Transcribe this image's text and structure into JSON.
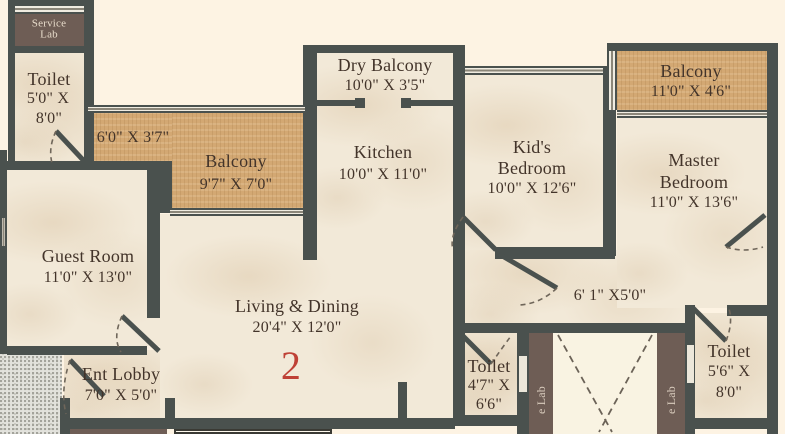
{
  "colors": {
    "wall": "#4a514e",
    "floor": "#f2e9d8",
    "balcony_tan": "#d3a873",
    "service_brown": "#6e5d55",
    "label_text": "#43342a",
    "unit_number_red": "#bf4136",
    "outside_bg": "#fdf3e3"
  },
  "unit_number": "2",
  "rooms": {
    "service_lab": {
      "line1": "Service",
      "line2": "Lab"
    },
    "toilet_top": {
      "name": "Toilet",
      "dim1": "5'0\" X",
      "dim2": "8'0\""
    },
    "balcony_passage": {
      "dims": "6'0\" X 3'7\""
    },
    "balcony_left": {
      "name": "Balcony",
      "dims": "9'7\" X 7'0\""
    },
    "dry_balcony": {
      "name": "Dry Balcony",
      "dims": "10'0\" X 3'5\""
    },
    "kitchen": {
      "name": "Kitchen",
      "dims": "10'0\" X 11'0\""
    },
    "kids_bedroom": {
      "line1": "Kid's",
      "line2": "Bedroom",
      "dims": "10'0\" X 12'6\""
    },
    "balcony_right": {
      "name": "Balcony",
      "dims": "11'0\" X 4'6\""
    },
    "master_bedroom": {
      "line1": "Master",
      "line2": "Bedroom",
      "dims": "11'0\" X 13'6\""
    },
    "guest_room": {
      "name": "Guest Room",
      "dims": "11'0\" X 13'0\""
    },
    "living_dining": {
      "name": "Living & Dining",
      "dims": "20'4\" X 12'0\""
    },
    "ent_lobby": {
      "name": "Ent Lobby",
      "dims": "7'0\" X 5'0\""
    },
    "passage": {
      "dims": "6' 1\" X5'0\""
    },
    "toilet_mid": {
      "name": "Toilet",
      "dim1": "4'7\" X",
      "dim2": "6'6\""
    },
    "toilet_right": {
      "name": "Toilet",
      "dim1": "5'6\" X",
      "dim2": "8'0\""
    },
    "duct_left": {
      "label": "e Lab"
    },
    "duct_right": {
      "label": "e Lab"
    }
  }
}
